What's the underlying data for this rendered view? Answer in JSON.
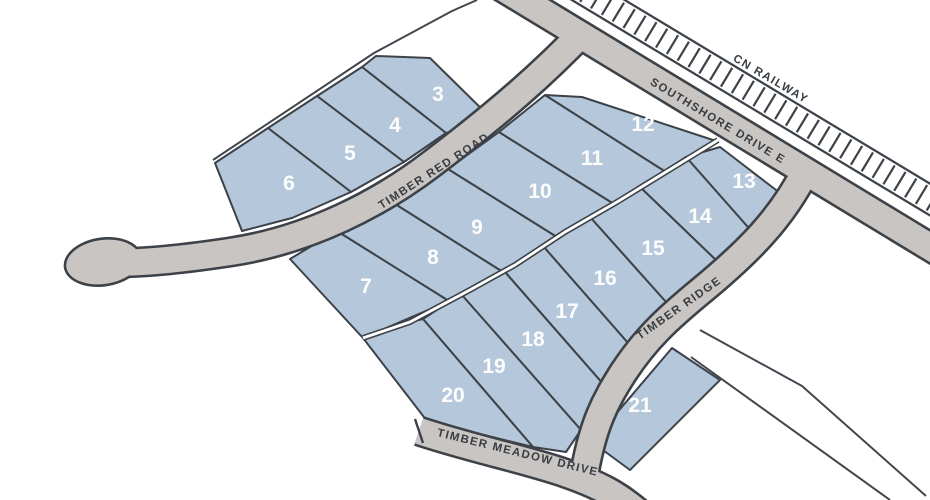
{
  "map": {
    "title": "Subdivision lot plan",
    "canvas": {
      "width": 930,
      "height": 500
    },
    "colors": {
      "background": "#ffffff",
      "lot_fill": "#b5c7da",
      "lot_stroke": "#3c4248",
      "road_fill": "#c9c5c2",
      "road_casing": "#3c4248",
      "railway_fill": "#ffffff",
      "boundary": "#42474d",
      "label_color": "#383d42",
      "number_color": "#fdfdfd"
    },
    "railway": {
      "label": "CN RAILWAY",
      "x1": 575,
      "y1": -14,
      "x2": 954,
      "y2": 214,
      "width": 25,
      "tie_spacing": 12.5,
      "tie_half": 11,
      "label_pos": [
        769,
        82
      ],
      "label_rot": 30.5
    },
    "roads": [
      {
        "id": "southshore",
        "label": "SOUTHSHORE DRIVE E",
        "path": "M 498 -15 L 940 253",
        "width": 26,
        "label_pos": [
          716,
          124
        ],
        "label_rot": 31
      },
      {
        "id": "timber-red",
        "label": "TIMBER RED ROAD",
        "path": "M 585 30 C 545 72 500 112 430 165 C 380 203 310 240 230 252 C 190 258 150 263 106 263",
        "width": 26,
        "label_pos": [
          436,
          174
        ],
        "label_rot": -33,
        "culdesac": {
          "cx": 103,
          "cy": 262,
          "rx": 37,
          "ry": 22,
          "rot": -8
        }
      },
      {
        "id": "timber-ridge",
        "label": "TIMBER RIDGE",
        "path": "M 806 170 C 782 218 748 252 702 290 C 668 318 646 338 623 373 C 606 400 592 424 583 482",
        "width": 26,
        "label_pos": [
          681,
          311
        ],
        "label_rot": -35
      },
      {
        "id": "timber-meadow",
        "label": "TIMBER MEADOW DRIVE",
        "path": "M 419 431 C 470 448 520 458 562 472 C 600 485 618 495 640 514",
        "width": 26,
        "label_pos": [
          517,
          456
        ],
        "label_rot": 14,
        "end_cap": [
          415,
          419,
          423,
          443
        ]
      }
    ],
    "rear_line": {
      "points": "718,140 617,202 565,232 515,265 468,291 410,322 363,338"
    },
    "boundaries": [
      {
        "id": "northwest-plat-boundary",
        "points": "213,160 374,53 452,11 477,0"
      },
      {
        "id": "east-parcel-line-1",
        "points": "700,330 802,386 926,496"
      },
      {
        "id": "east-parcel-line-2",
        "points": "691,357 890,500"
      }
    ],
    "lots": [
      {
        "number": "3",
        "points": "362,67 376,56 430,58 495,122 446,133",
        "num_pos": [
          438,
          94
        ]
      },
      {
        "number": "4",
        "points": "317,96 362,67 446,133 404,162",
        "num_pos": [
          395,
          125
        ]
      },
      {
        "number": "5",
        "points": "268,128 317,96 404,162 351,192",
        "num_pos": [
          350,
          153
        ]
      },
      {
        "number": "6",
        "points": "215,163 268,128 351,192 292,218 242,231",
        "num_pos": [
          289,
          183
        ]
      },
      {
        "number": "7",
        "points": "337,231 449,301 363,338 290,259 315,244",
        "num_pos": [
          366,
          286
        ]
      },
      {
        "number": "8",
        "points": "392,202 503,272 449,301 337,231",
        "num_pos": [
          433,
          257
        ]
      },
      {
        "number": "9",
        "points": "448,169 557,237 503,272 392,202",
        "num_pos": [
          477,
          227
        ]
      },
      {
        "number": "10",
        "points": "499,132 614,204 557,237 448,169",
        "num_pos": [
          540,
          191
        ]
      },
      {
        "number": "11",
        "points": "545,95 666,172 614,204 499,132",
        "num_pos": [
          592,
          158
        ]
      },
      {
        "number": "12",
        "points": "582,97 716,141 666,172 545,95",
        "num_pos": [
          643,
          124
        ]
      },
      {
        "number": "13",
        "points": "720,147 780,193 754,234 686,157",
        "num_pos": [
          744,
          181
        ]
      },
      {
        "number": "14",
        "points": "686,157 754,234 719,263 640,187",
        "num_pos": [
          700,
          216
        ]
      },
      {
        "number": "15",
        "points": "640,187 719,263 666,302 590,217",
        "num_pos": [
          653,
          248
        ]
      },
      {
        "number": "16",
        "points": "590,217 666,302 628,343 543,246",
        "num_pos": [
          605,
          278
        ]
      },
      {
        "number": "17",
        "points": "543,246 628,343 604,385 505,272",
        "num_pos": [
          567,
          311
        ]
      },
      {
        "number": "18",
        "points": "505,272 604,385 581,430 461,294",
        "num_pos": [
          533,
          339
        ]
      },
      {
        "number": "19",
        "points": "461,294 581,430 566,452 533,447 423,319",
        "num_pos": [
          494,
          366
        ]
      },
      {
        "number": "20",
        "points": "363,338 410,322 423,319 533,447 427,421",
        "num_pos": [
          453,
          395
        ]
      },
      {
        "number": "21",
        "points": "672,348 720,380 630,470 592,442",
        "num_pos": [
          640,
          405
        ]
      }
    ]
  }
}
